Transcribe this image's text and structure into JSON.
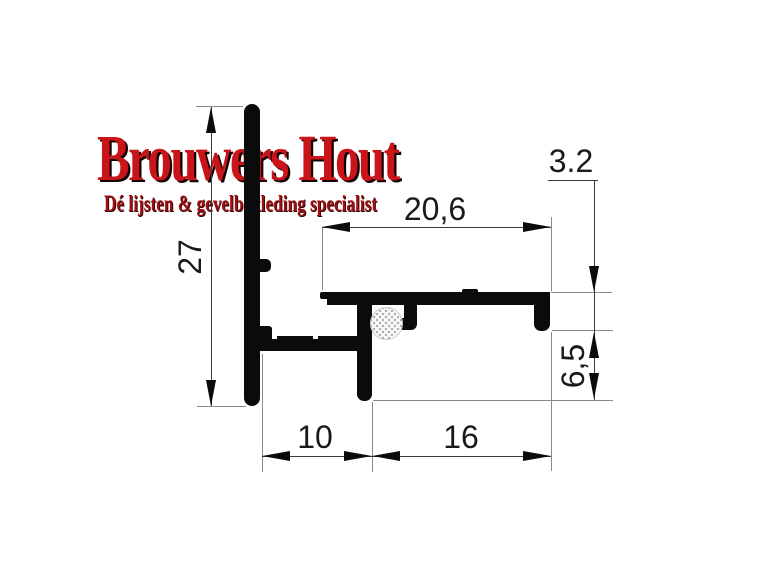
{
  "logo": {
    "title": "Brouwers Hout",
    "subtitle": "Dé lijsten & gevelbekleding specialist",
    "title_color": "#c9141a",
    "subtitle_color": "#9c1013"
  },
  "drawing": {
    "description": "Technical cross-section drawing of an aluminium end profile with rubber gasket",
    "profile_color": "#0b0b0b",
    "dims": {
      "height": "27",
      "top_width": "20,6",
      "hook_height": "3.2",
      "drip_height": "6,5",
      "base_left": "10",
      "base_right": "16"
    }
  }
}
